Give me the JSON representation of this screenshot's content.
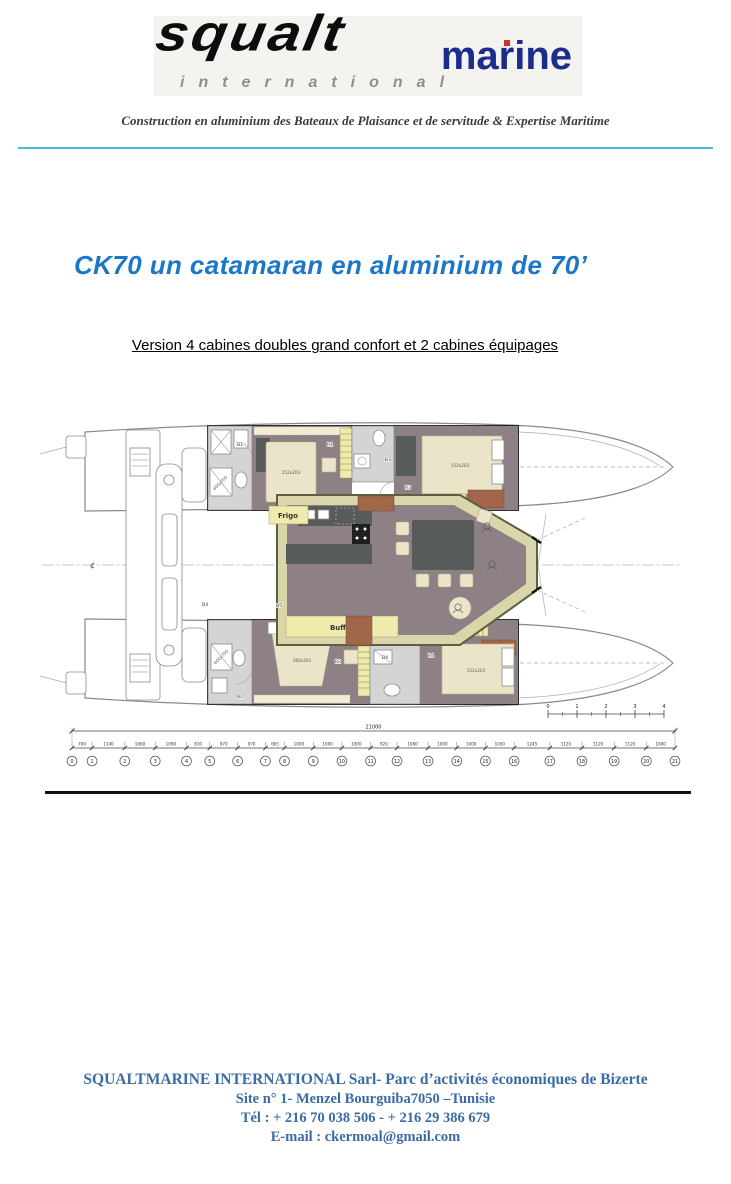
{
  "logo": {
    "brand": "squalt",
    "sub_brand": "marine",
    "tagline_word": "international"
  },
  "header": {
    "tagline": "Construction en aluminium des Bateaux de Plaisance et de servitude & Expertise Maritime"
  },
  "title": "CK70 un catamaran en aluminium de 70’",
  "subtitle": "Version 4 cabines doubles grand confort et 2 cabines équipages",
  "plan": {
    "labels": {
      "frigo": "Frigo",
      "buffet": "Buffet",
      "bed_double": "152x203",
      "bed_owner": "160x201",
      "shower": "600x700",
      "centerline": "¢"
    },
    "rooms": {
      "b1": "B1",
      "r1": "R1",
      "b3": "B3",
      "r3": "R3",
      "b2": "B2",
      "r2": "R2",
      "b4": "B4",
      "r4": "R4",
      "d4": "D4",
      "d5": "D5"
    },
    "scalebar": [
      "0",
      "1",
      "2",
      "3",
      "4"
    ]
  },
  "dimensions": {
    "total": "21000",
    "segments": [
      700,
      1140,
      1060,
      1090,
      810,
      970,
      970,
      665,
      1000,
      1000,
      1000,
      920,
      1080,
      1000,
      1000,
      1000,
      1245,
      1120,
      1120,
      1120,
      1000
    ],
    "stations": [
      "0",
      "1",
      "2",
      "3",
      "4",
      "5",
      "6",
      "7",
      "8",
      "9",
      "10",
      "11",
      "12",
      "13",
      "14",
      "15",
      "16",
      "17",
      "18",
      "19",
      "20",
      "21"
    ]
  },
  "footer": {
    "lines": [
      "SQUALTMARINE  INTERNATIONAL Sarl- Parc d’activités économiques de Bizerte",
      "Site n° 1-   Menzel Bourguiba7050  –Tunisie",
      "Tél : + 216 70 038 506 - + 216 29 386 679",
      "E-mail : ckermoal@gmail.com"
    ]
  }
}
